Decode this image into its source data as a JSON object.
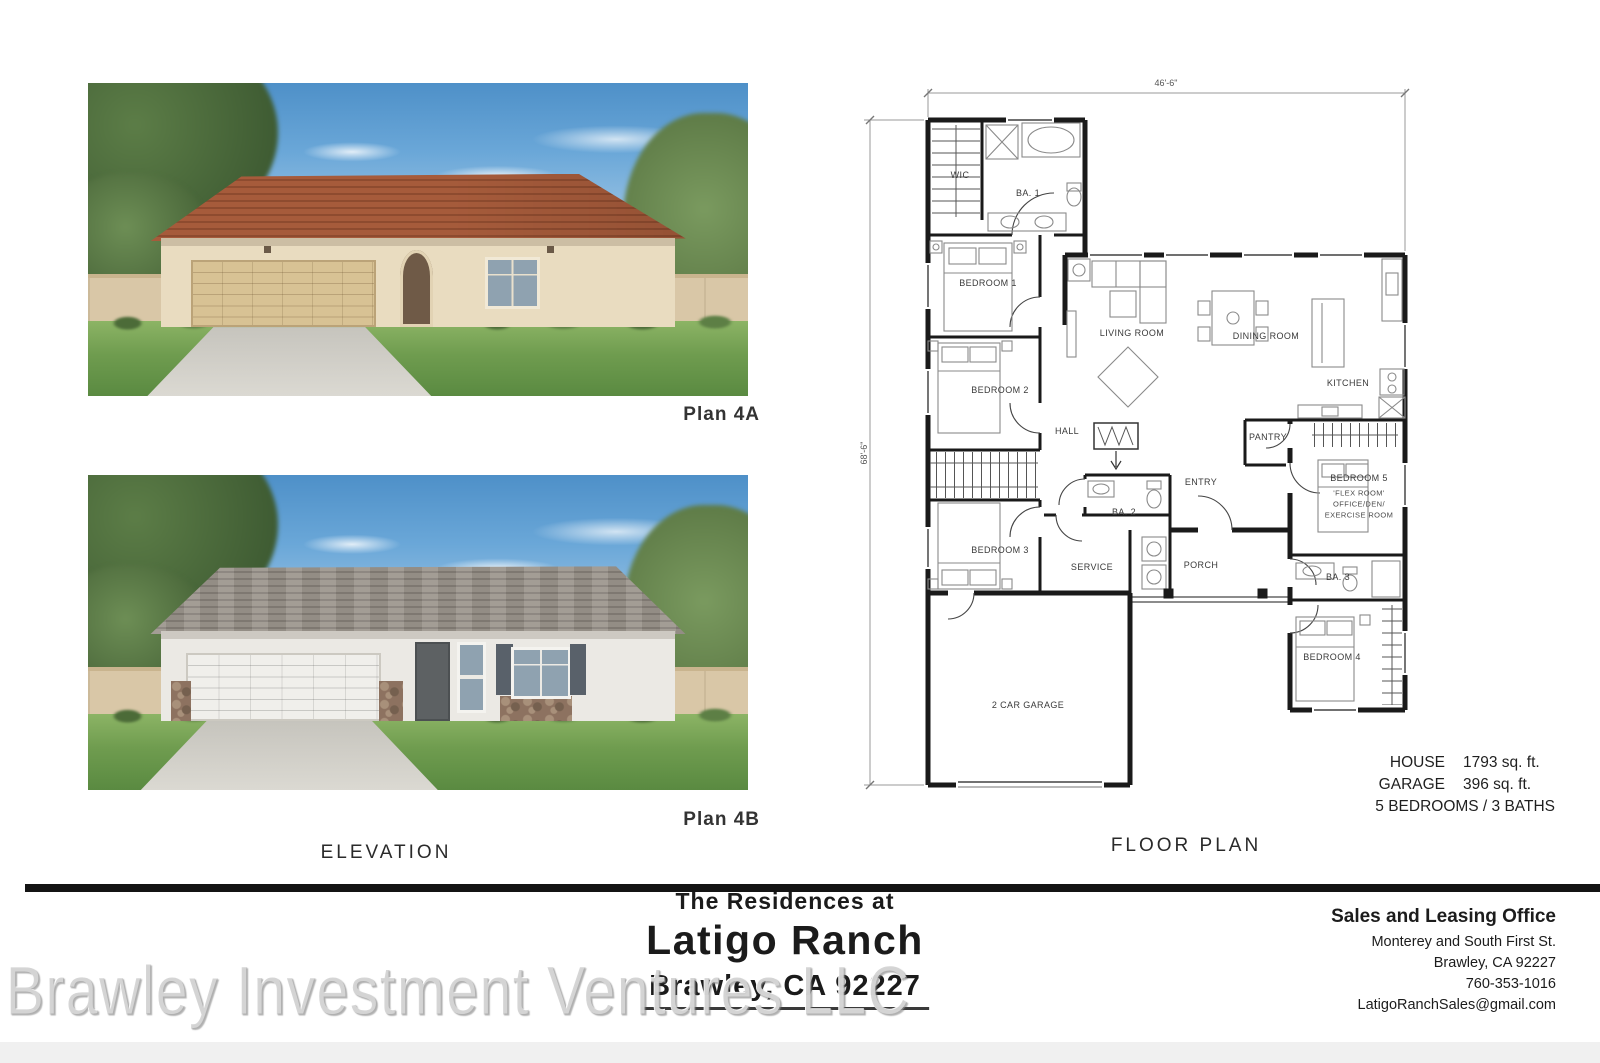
{
  "sections": {
    "elevation_label": "ELEVATION",
    "floor_plan_label": "FLOOR PLAN"
  },
  "elevations": {
    "plan_a_label": "Plan 4A",
    "plan_b_label": "Plan 4B"
  },
  "floor_plan": {
    "dimensions": {
      "width": "46'-6\"",
      "height": "68'-6\""
    },
    "rooms": {
      "wic": "WIC",
      "ba_1": "BA. 1",
      "bedroom_1": "BEDROOM 1",
      "bedroom_2": "BEDROOM 2",
      "hall": "HALL",
      "bedroom_3": "BEDROOM 3",
      "ba_2": "BA. 2",
      "service": "SERVICE",
      "entry": "ENTRY",
      "porch": "PORCH",
      "living_room": "LIVING ROOM",
      "dining_room": "DINING ROOM",
      "kitchen": "KITCHEN",
      "pantry": "PANTRY",
      "bedroom_5": "BEDROOM 5",
      "bedroom_5_alt_1": "'FLEX ROOM'",
      "bedroom_5_alt_2": "OFFICE/DEN/",
      "bedroom_5_alt_3": "EXERCISE ROOM",
      "ba_3": "BA. 3",
      "bedroom_4": "BEDROOM 4",
      "garage": "2 CAR GARAGE"
    },
    "stats": {
      "house_label": "HOUSE",
      "house_value": "1793 sq. ft.",
      "garage_label": "GARAGE",
      "garage_value": "396 sq. ft.",
      "bedrooms_baths": "5 BEDROOMS / 3 BATHS"
    }
  },
  "footer": {
    "community": {
      "prefix": "The Residences at",
      "name": "Latigo Ranch",
      "location": "Brawley, CA 92227"
    },
    "office": {
      "heading": "Sales and Leasing Office",
      "address_line_1": "Monterey and South First St.",
      "address_line_2": "Brawley, CA 92227",
      "phone": "760-353-1016",
      "email": "LatigoRanchSales@gmail.com"
    }
  },
  "watermark": "Brawley Investment Ventures LLC"
}
